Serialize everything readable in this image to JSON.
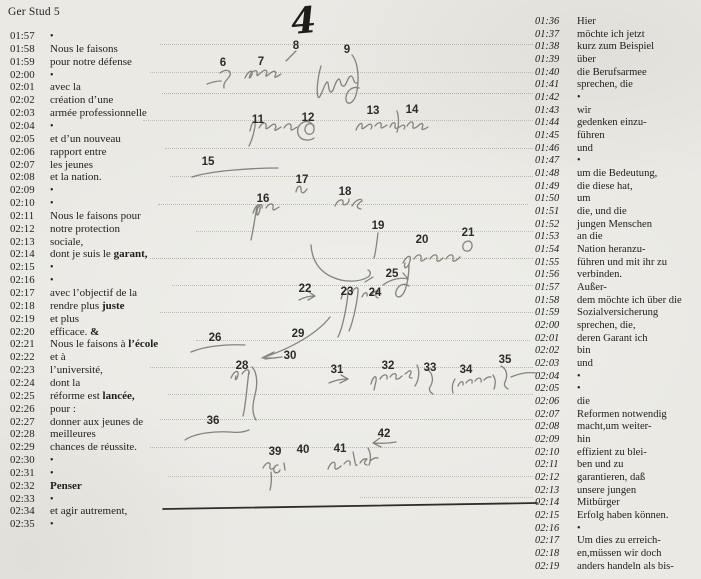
{
  "header": {
    "title": "Ger Stud 5"
  },
  "page_number": "4",
  "left_column": {
    "language": "French source speech",
    "rows": [
      {
        "t": "01:57",
        "text": "•"
      },
      {
        "t": "01:58",
        "text": "Nous le faisons"
      },
      {
        "t": "01:59",
        "text": "pour notre défense"
      },
      {
        "t": "02:00",
        "text": "•"
      },
      {
        "t": "02:01",
        "text": "avec la"
      },
      {
        "t": "02:02",
        "text": "création d’une"
      },
      {
        "t": "02:03",
        "text": "armée professionnelle"
      },
      {
        "t": "02:04",
        "text": "•"
      },
      {
        "t": "02:05",
        "text": "et d’un nouveau"
      },
      {
        "t": "02:06",
        "text": "rapport entre"
      },
      {
        "t": "02:07",
        "text": "les jeunes"
      },
      {
        "t": "02:08",
        "text": "et la nation."
      },
      {
        "t": "02:09",
        "text": "•"
      },
      {
        "t": "02:10",
        "text": "•"
      },
      {
        "t": "02:11",
        "text": "Nous le faisons pour"
      },
      {
        "t": "02:12",
        "text": "notre protection"
      },
      {
        "t": "02:13",
        "text": "sociale,"
      },
      {
        "t": "02:14",
        "text": "dont je suis le ",
        "bold": "garant,"
      },
      {
        "t": "02:15",
        "text": "•"
      },
      {
        "t": "02:16",
        "text": "•"
      },
      {
        "t": "02:17",
        "text": "avec l’objectif de la"
      },
      {
        "t": "02:18",
        "text": "rendre plus ",
        "bold": "juste"
      },
      {
        "t": "02:19",
        "text": "et plus"
      },
      {
        "t": "02:20",
        "text": "efficace. ",
        "bold": "&"
      },
      {
        "t": "02:21",
        "text": "Nous le faisons à ",
        "bold": "l’école"
      },
      {
        "t": "02:22",
        "text": "et à"
      },
      {
        "t": "02:23",
        "text": "l’université,"
      },
      {
        "t": "02:24",
        "text": "dont la"
      },
      {
        "t": "02:25",
        "text": "réforme est ",
        "bold": "lancée,"
      },
      {
        "t": "02:26",
        "text": "pour :"
      },
      {
        "t": "02:27",
        "text": "donner aux jeunes de"
      },
      {
        "t": "02:28",
        "text": "meilleures"
      },
      {
        "t": "02:29",
        "text": "chances de réussite."
      },
      {
        "t": "02:30",
        "text": "•"
      },
      {
        "t": "02:31",
        "text": "•"
      },
      {
        "t": "02:32",
        "text": "",
        "bold": "Penser"
      },
      {
        "t": "02:33",
        "text": "•"
      },
      {
        "t": "02:34",
        "text": "et agir autrement,"
      },
      {
        "t": "02:35",
        "text": "•"
      }
    ]
  },
  "right_column": {
    "language": "German interpretation",
    "rows": [
      {
        "t": "01:36",
        "text": "Hier"
      },
      {
        "t": "01:37",
        "text": "möchte ich jetzt"
      },
      {
        "t": "01:38",
        "text": "kurz zum Beispiel"
      },
      {
        "t": "01:39",
        "text": "über"
      },
      {
        "t": "01:40",
        "text": "die Berufsarmee"
      },
      {
        "t": "01:41",
        "text": "sprechen, die"
      },
      {
        "t": "01:42",
        "text": "•"
      },
      {
        "t": "01:43",
        "text": "wir"
      },
      {
        "t": "01:44",
        "text": "gedenken einzu-"
      },
      {
        "t": "01:45",
        "text": "führen"
      },
      {
        "t": "01:46",
        "text": "und"
      },
      {
        "t": "01:47",
        "text": "•"
      },
      {
        "t": "01:48",
        "text": "um die Bedeutung,"
      },
      {
        "t": "01:49",
        "text": "die diese hat,"
      },
      {
        "t": "01:50",
        "text": "um"
      },
      {
        "t": "01:51",
        "text": "die, und die"
      },
      {
        "t": "01:52",
        "text": "jungen Menschen"
      },
      {
        "t": "01:53",
        "text": "an die"
      },
      {
        "t": "01:54",
        "text": "Nation heranzu-"
      },
      {
        "t": "01:55",
        "text": "führen und mit ihr zu"
      },
      {
        "t": "01:56",
        "text": "verbinden."
      },
      {
        "t": "01:57",
        "text": "Außer-"
      },
      {
        "t": "01:58",
        "text": "dem möchte ich über die"
      },
      {
        "t": "01:59",
        "text": "Sozialversicherung"
      },
      {
        "t": "02:00",
        "text": "sprechen, die,"
      },
      {
        "t": "02:01",
        "text": "deren Garant ich"
      },
      {
        "t": "02:02",
        "text": "bin"
      },
      {
        "t": "02:03",
        "text": "und"
      },
      {
        "t": "02:04",
        "text": "•"
      },
      {
        "t": "02:05",
        "text": "•"
      },
      {
        "t": "02:06",
        "text": "die"
      },
      {
        "t": "02:07",
        "text": "Reformen notwendig"
      },
      {
        "t": "02:08",
        "text": "macht,um weiter-"
      },
      {
        "t": "02:09",
        "text": "hin"
      },
      {
        "t": "02:10",
        "text": "effizient zu blei-"
      },
      {
        "t": "02:11",
        "text": "ben und zu"
      },
      {
        "t": "02:12",
        "text": "garantieren, daß"
      },
      {
        "t": "02:13",
        "text": "unsere jungen"
      },
      {
        "t": "02:14",
        "text": "Mitbürger"
      },
      {
        "t": "02:15",
        "text": "Erfolg haben können."
      },
      {
        "t": "02:16",
        "text": "•"
      },
      {
        "t": "02:17",
        "text": "Um dies zu erreich-"
      },
      {
        "t": "02:18",
        "text": "en,müssen wir doch"
      },
      {
        "t": "02:19",
        "text": "anders handeln als bis-"
      }
    ]
  },
  "annotations": {
    "numbers": [
      {
        "n": "6",
        "x": 223,
        "y": 63
      },
      {
        "n": "7",
        "x": 261,
        "y": 62
      },
      {
        "n": "8",
        "x": 296,
        "y": 46
      },
      {
        "n": "9",
        "x": 347,
        "y": 50
      },
      {
        "n": "11",
        "x": 258,
        "y": 120
      },
      {
        "n": "12",
        "x": 308,
        "y": 118
      },
      {
        "n": "13",
        "x": 373,
        "y": 111
      },
      {
        "n": "14",
        "x": 412,
        "y": 110
      },
      {
        "n": "15",
        "x": 208,
        "y": 162
      },
      {
        "n": "16",
        "x": 263,
        "y": 199
      },
      {
        "n": "17",
        "x": 302,
        "y": 180
      },
      {
        "n": "18",
        "x": 345,
        "y": 192
      },
      {
        "n": "19",
        "x": 378,
        "y": 226
      },
      {
        "n": "20",
        "x": 422,
        "y": 240
      },
      {
        "n": "21",
        "x": 468,
        "y": 233
      },
      {
        "n": "22",
        "x": 305,
        "y": 289
      },
      {
        "n": "23",
        "x": 347,
        "y": 292
      },
      {
        "n": "24",
        "x": 375,
        "y": 293
      },
      {
        "n": "25",
        "x": 392,
        "y": 274
      },
      {
        "n": "26",
        "x": 215,
        "y": 338
      },
      {
        "n": "28",
        "x": 242,
        "y": 366
      },
      {
        "n": "29",
        "x": 298,
        "y": 334
      },
      {
        "n": "30",
        "x": 290,
        "y": 356
      },
      {
        "n": "31",
        "x": 337,
        "y": 370
      },
      {
        "n": "32",
        "x": 388,
        "y": 366
      },
      {
        "n": "33",
        "x": 430,
        "y": 368
      },
      {
        "n": "34",
        "x": 466,
        "y": 370
      },
      {
        "n": "35",
        "x": 505,
        "y": 360
      },
      {
        "n": "36",
        "x": 213,
        "y": 421
      },
      {
        "n": "39",
        "x": 275,
        "y": 452
      },
      {
        "n": "40",
        "x": 303,
        "y": 450
      },
      {
        "n": "41",
        "x": 340,
        "y": 449
      },
      {
        "n": "42",
        "x": 384,
        "y": 434
      }
    ]
  }
}
